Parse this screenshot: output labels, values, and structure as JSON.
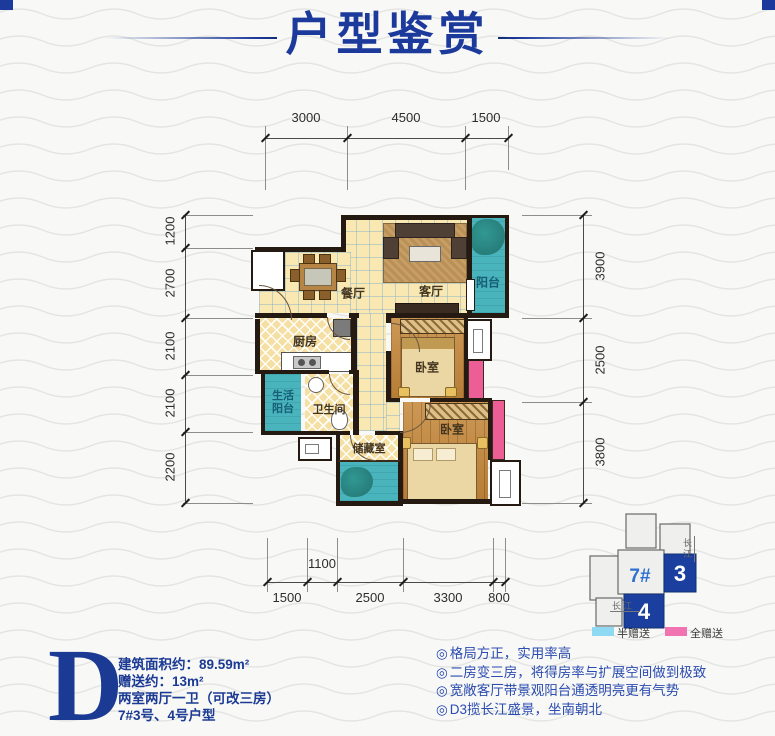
{
  "page": {
    "title": "户型鉴赏"
  },
  "rooms": {
    "dining": {
      "label": "餐厅"
    },
    "living": {
      "label": "客厅"
    },
    "balcony": {
      "label": "阳台"
    },
    "kitchen": {
      "label": "厨房"
    },
    "service_balcony": {
      "label": "生活阳台"
    },
    "bathroom": {
      "label": "卫生间"
    },
    "storage": {
      "label": "储藏室"
    },
    "bedroom1": {
      "label": "卧室"
    },
    "bedroom2": {
      "label": "卧室"
    }
  },
  "dims": {
    "top": [
      "3000",
      "4500",
      "1500"
    ],
    "left": [
      "1200",
      "2700",
      "2100",
      "2100",
      "2200"
    ],
    "right": [
      "3900",
      "2500",
      "3800"
    ],
    "bottom_inner": "1100",
    "bottom": [
      "1500",
      "2500",
      "3300",
      "800"
    ]
  },
  "locator": {
    "building": "7#",
    "unit_3": "3",
    "unit_4": "4",
    "river_side": "长江",
    "river_bottom": "长江"
  },
  "legend": {
    "half": {
      "label": "半赠送",
      "color": "#8fd9f2"
    },
    "full": {
      "label": "全赠送",
      "color": "#f173b2"
    }
  },
  "info": {
    "letter": "D",
    "lines": [
      "建筑面积约：89.59m²",
      "赠送约：13m²",
      "两室两厅一卫（可改三房）",
      "7#3号、4号户型"
    ]
  },
  "features": {
    "bullet": "◎",
    "items": [
      "格局方正，实用率高",
      "二房变三房，将得房率与扩展空间做到极致",
      "宽敞客厅带景观阳台通透明亮更有气势",
      "D3揽长江盛景，坐南朝北"
    ]
  },
  "colors": {
    "accent_blue": "#1b3a94",
    "balcony_teal": "#4ab4bc",
    "gift_pink": "#ec5e95",
    "floor_yellow": "#f9e8b2",
    "wood": "#c4873a",
    "legend_half": "#8fd9f2",
    "legend_full": "#f173b2"
  }
}
